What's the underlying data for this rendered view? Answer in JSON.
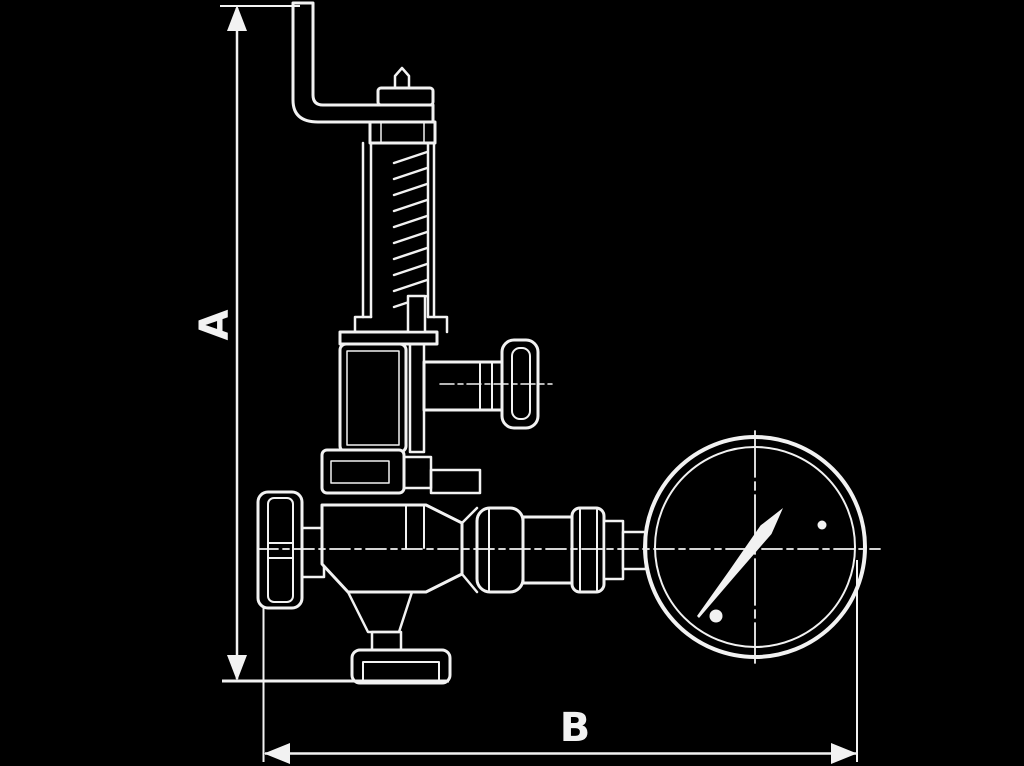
{
  "page": {
    "background": "#000000"
  },
  "drawing": {
    "kind": "technical dimensional drawing",
    "subject": "spring-loaded safety relief valve with lifting lever, gauge connection fittings and pressure gauge",
    "line_color": "#f2f2f2",
    "dimension_labels": {
      "height": "A",
      "width": "B"
    },
    "parts": [
      "lifting-lever",
      "spindle-cap",
      "spring-bonnet-column",
      "spring",
      "bonnet-block",
      "test-knob",
      "bonnet-flange",
      "side-cap",
      "valve-body",
      "inlet-neck",
      "inlet-flange",
      "gauge-connection-fittings",
      "pressure-gauge",
      "gauge-needle"
    ]
  }
}
